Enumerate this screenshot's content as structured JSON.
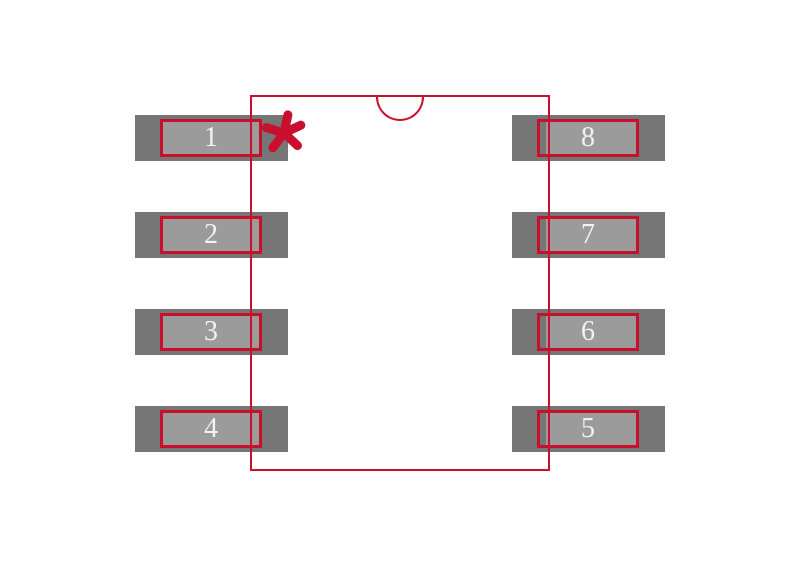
{
  "diagram": {
    "kind": "ic-footprint-land-pattern",
    "package_outline": "rectangle with top-center semicircular orientation notch",
    "pin_count_visible": 8
  },
  "colors": {
    "accent_red": "#c8102e",
    "pad_copper": "#767676",
    "pad_paste": "#9b9b9b",
    "pin_number": "#f2f2f2",
    "canvas_bg": "#ffffff"
  },
  "pin1_marker": {
    "icon": "asterisk",
    "description": "five-spoke asterisk next to pad 1"
  },
  "pads": {
    "left": [
      {
        "number": "1"
      },
      {
        "number": "2"
      },
      {
        "number": "3"
      },
      {
        "number": "4"
      }
    ],
    "right": [
      {
        "number": "8"
      },
      {
        "number": "7"
      },
      {
        "number": "6"
      },
      {
        "number": "5"
      }
    ]
  }
}
